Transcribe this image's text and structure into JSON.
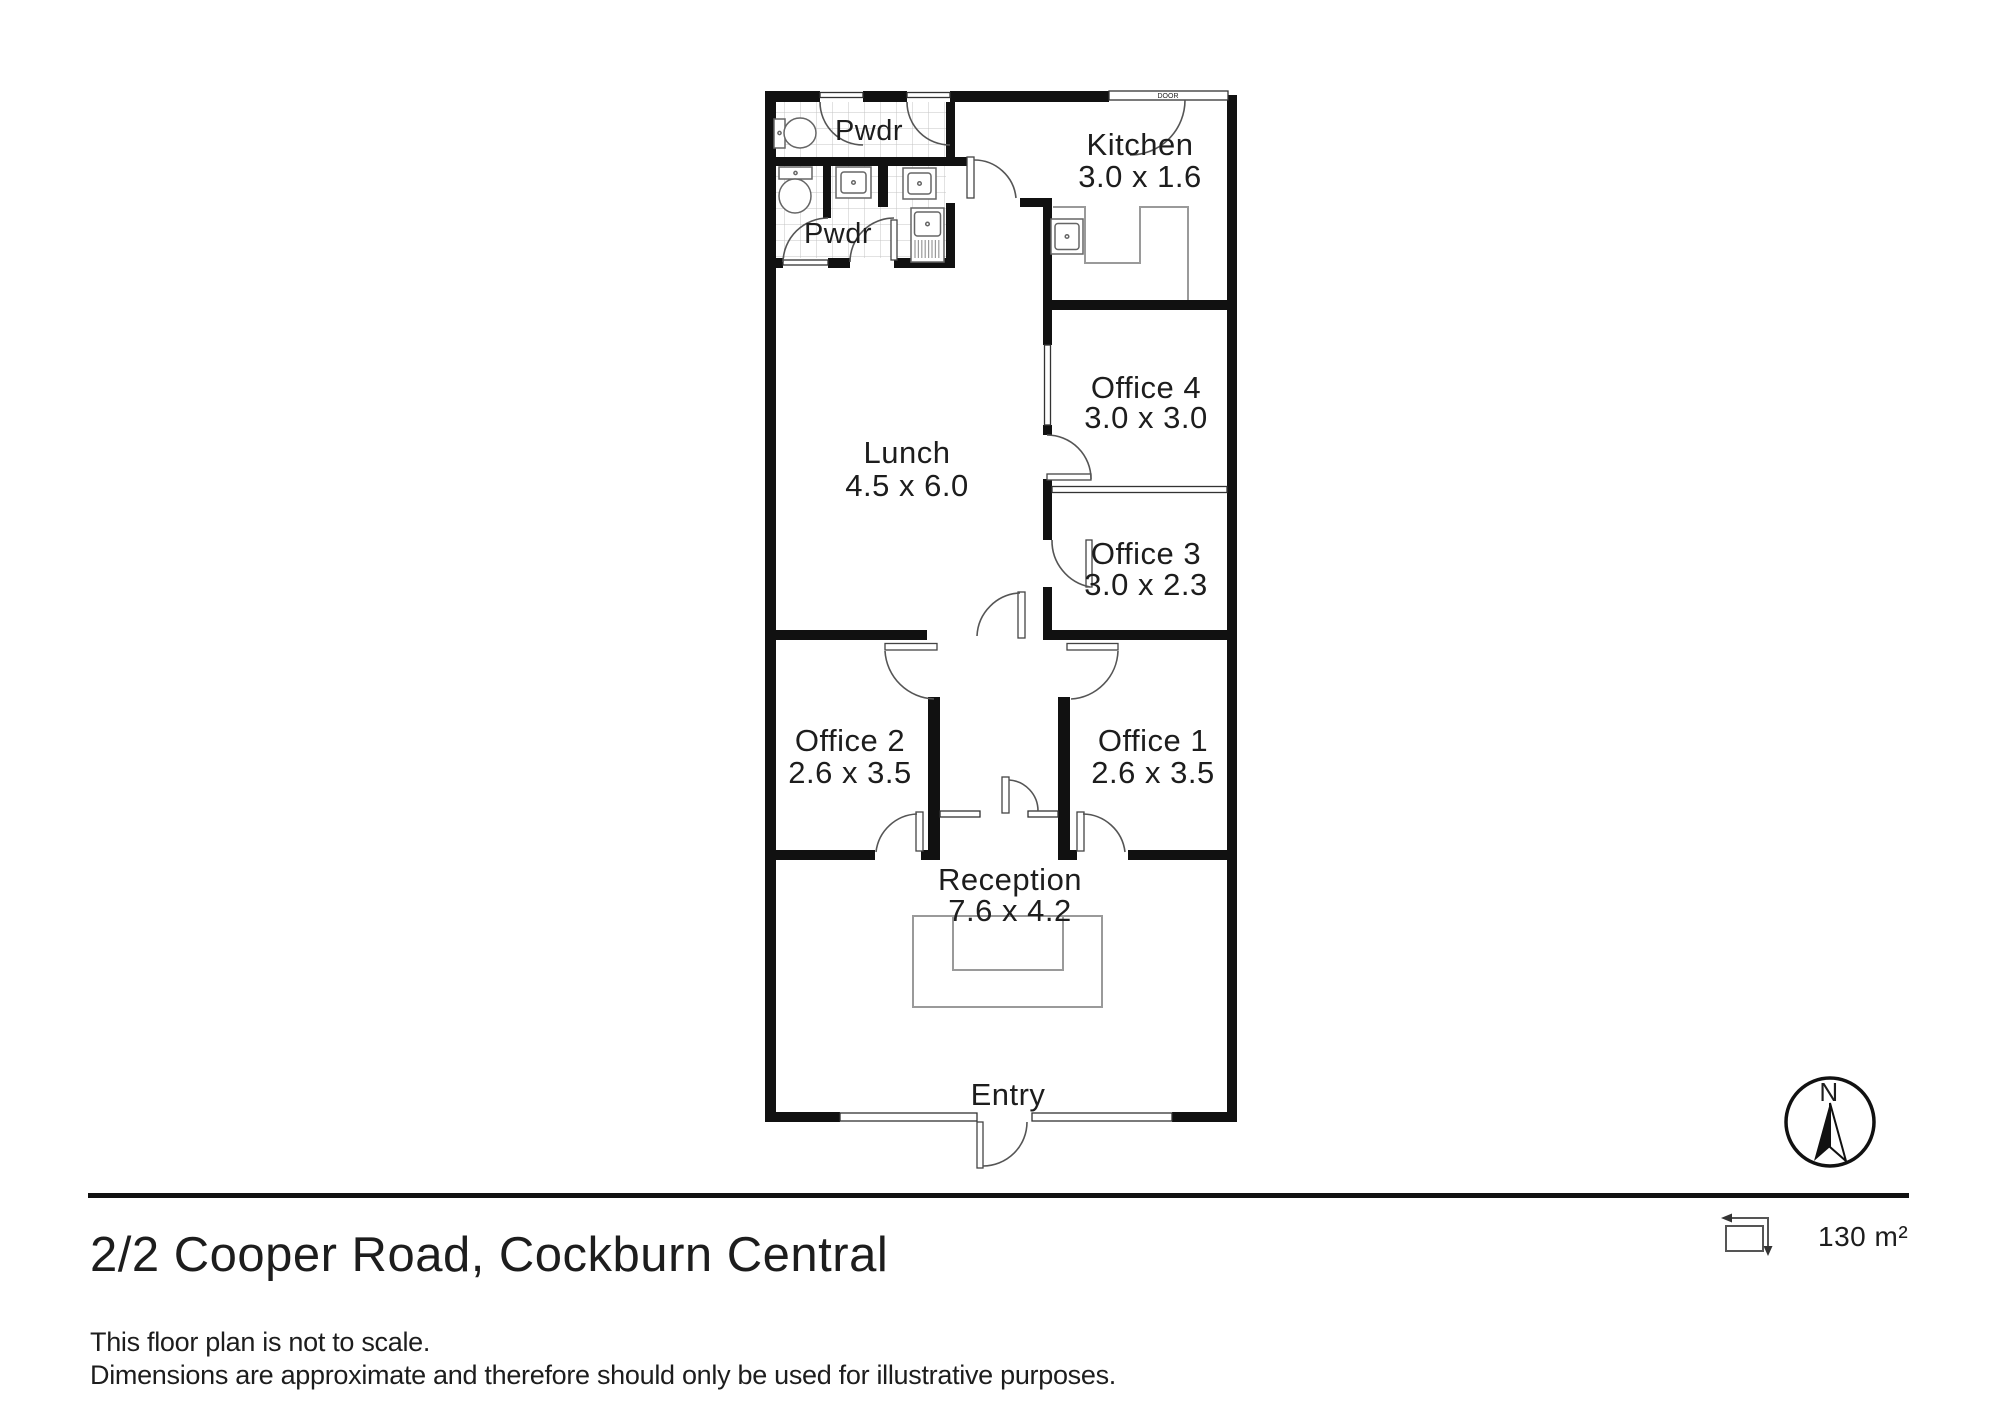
{
  "title": "2/2 Cooper Road, Cockburn Central",
  "area": {
    "value": "130 m²"
  },
  "compass": {
    "north": "N"
  },
  "door": {
    "label": "DOOR"
  },
  "disclaimer": {
    "line1": "This floor plan is not to scale.",
    "line2": "Dimensions are approximate and therefore should only be used for illustrative purposes."
  },
  "rooms": {
    "pwdr_top": {
      "name": "Pwdr"
    },
    "pwdr_lower": {
      "name": "Pwdr"
    },
    "kitchen": {
      "name": "Kitchen",
      "dims": "3.0 x 1.6"
    },
    "lunch": {
      "name": "Lunch",
      "dims": "4.5 x 6.0"
    },
    "office4": {
      "name": "Office 4",
      "dims": "3.0 x 3.0"
    },
    "office3": {
      "name": "Office 3",
      "dims": "3.0 x 2.3"
    },
    "office2": {
      "name": "Office 2",
      "dims": "2.6 x 3.5"
    },
    "office1": {
      "name": "Office 1",
      "dims": "2.6 x 3.5"
    },
    "reception": {
      "name": "Reception",
      "dims": "7.6 x 4.2"
    },
    "entry": {
      "name": "Entry"
    }
  }
}
